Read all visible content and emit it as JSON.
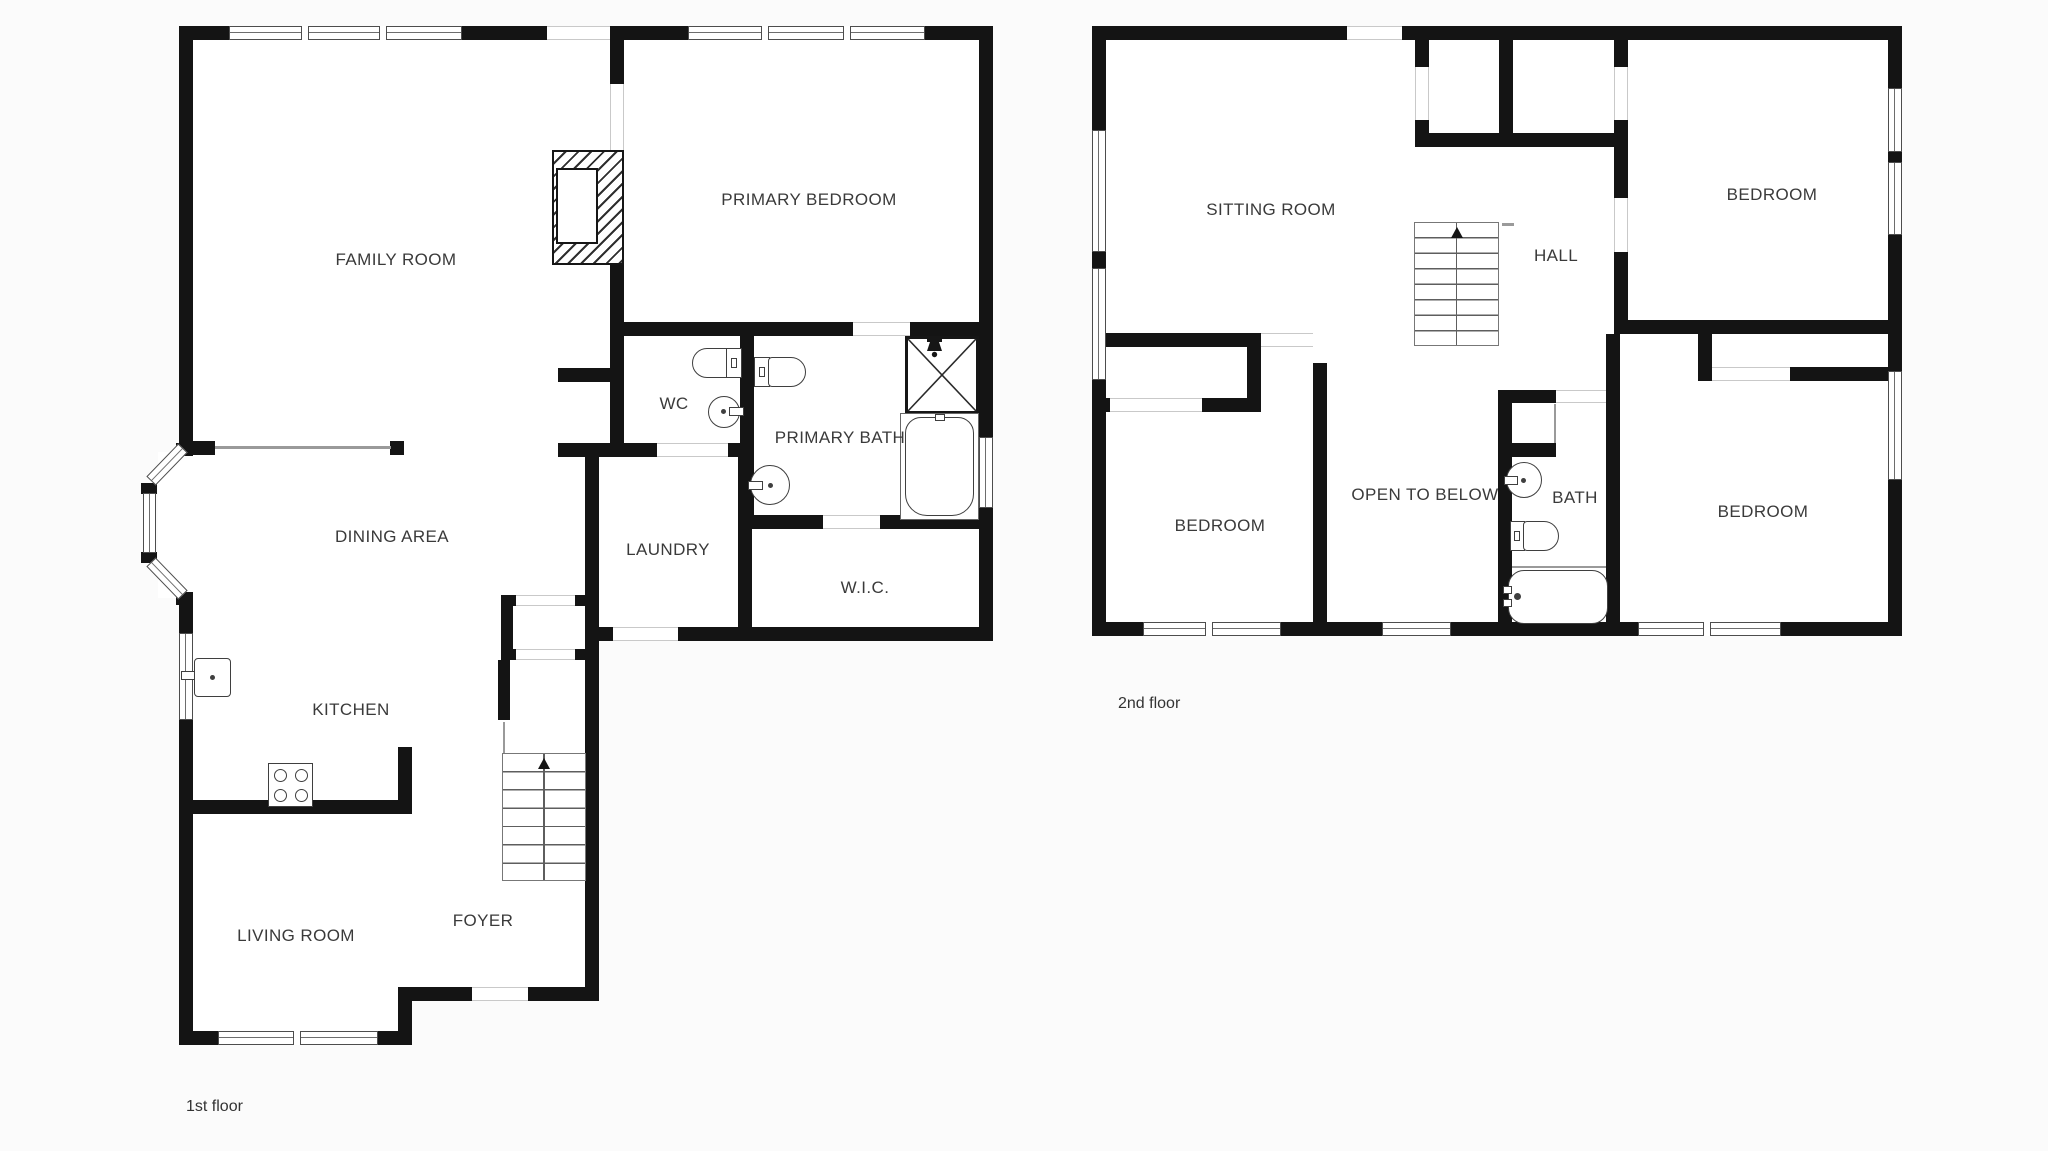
{
  "type": "floor-plan",
  "colors": {
    "wall": "#141414",
    "background": "#fbfbfb",
    "thin_line": "#9a9a9a",
    "text": "#3a3a3a"
  },
  "floors": {
    "first": {
      "caption": "1st floor",
      "rooms": {
        "family": {
          "label": "FAMILY ROOM"
        },
        "primary_bedroom": {
          "label": "PRIMARY BEDROOM"
        },
        "wc": {
          "label": "WC"
        },
        "primary_bath": {
          "label": "PRIMARY BATH"
        },
        "dining": {
          "label": "DINING AREA"
        },
        "laundry": {
          "label": "LAUNDRY"
        },
        "wic": {
          "label": "W.I.C."
        },
        "kitchen": {
          "label": "KITCHEN"
        },
        "foyer": {
          "label": "FOYER"
        },
        "living": {
          "label": "LIVING ROOM"
        }
      }
    },
    "second": {
      "caption": "2nd floor",
      "rooms": {
        "sitting": {
          "label": "SITTING ROOM"
        },
        "hall": {
          "label": "HALL"
        },
        "bedroom_ne": {
          "label": "BEDROOM"
        },
        "bedroom_sw": {
          "label": "BEDROOM"
        },
        "open_to_below": {
          "label": "OPEN TO BELOW"
        },
        "bath": {
          "label": "BATH"
        },
        "bedroom_se": {
          "label": "BEDROOM"
        }
      }
    }
  }
}
